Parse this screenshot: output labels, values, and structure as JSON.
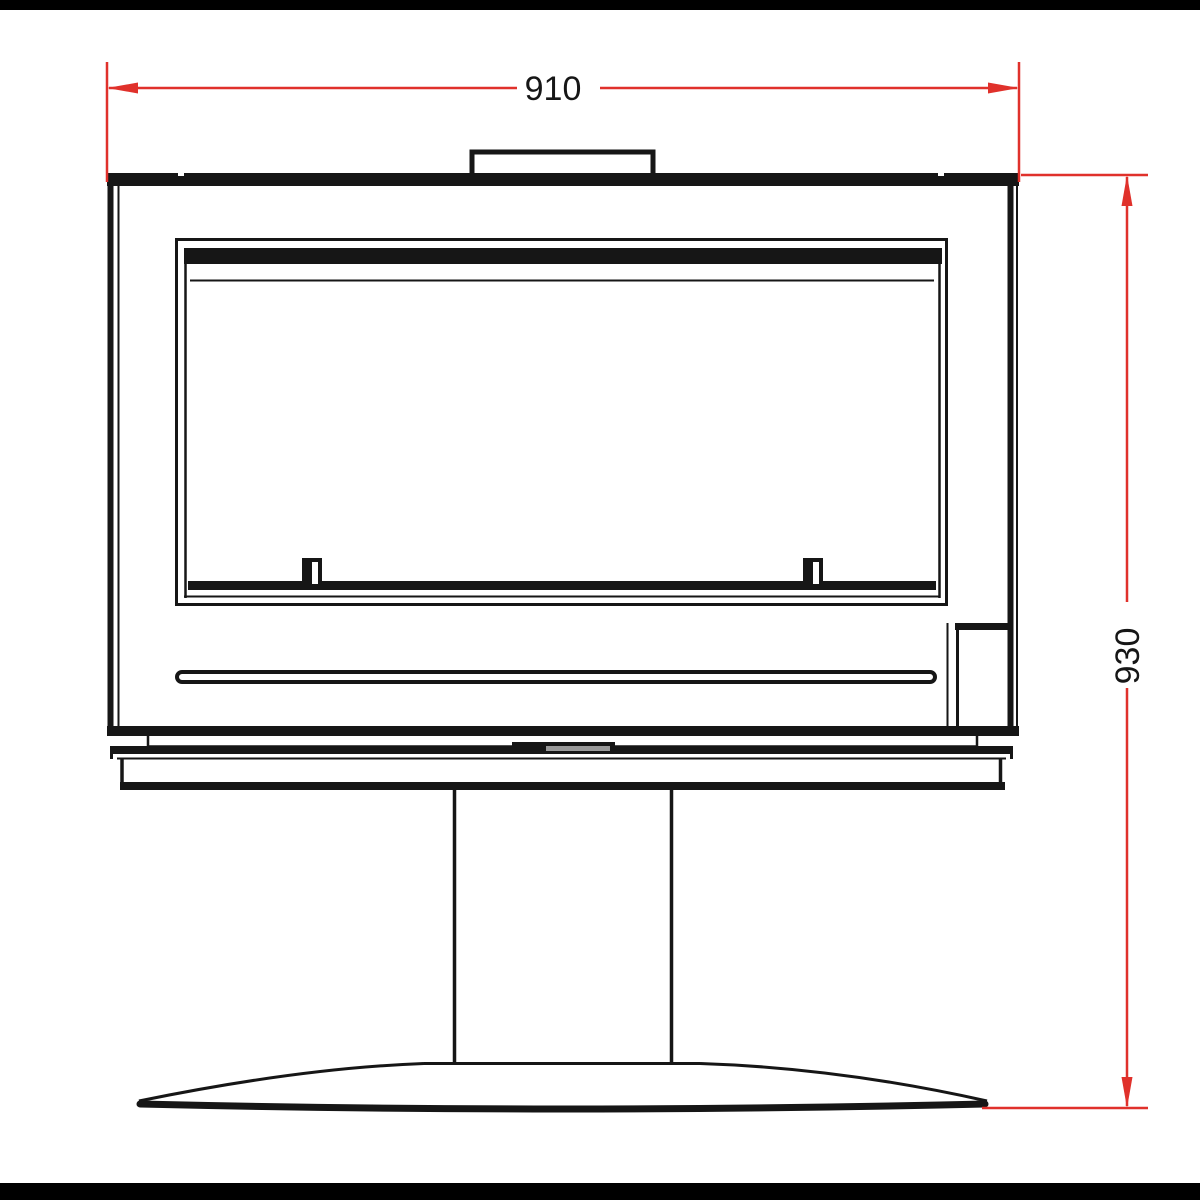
{
  "drawing": {
    "width_dimension": {
      "value": "910"
    },
    "height_dimension": {
      "value": "930"
    }
  },
  "colors": {
    "dimension": "#e0312b",
    "line": "#161616",
    "background": "#ffffff",
    "frame_bar": "#000000",
    "handle_accent": "#999999"
  }
}
